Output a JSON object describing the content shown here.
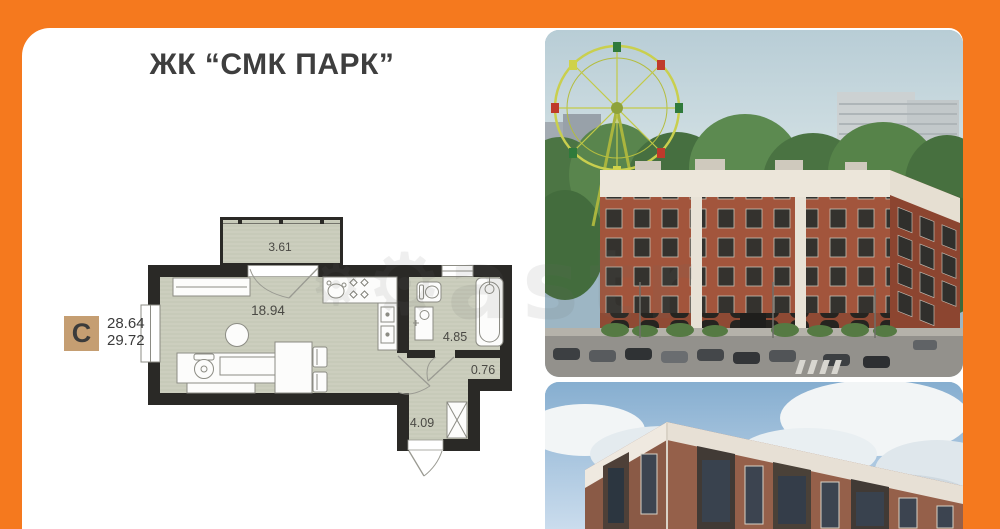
{
  "header": {
    "title": "ЖК “СМК ПАРК”"
  },
  "plan": {
    "badge": "С",
    "area_line1": "28.64",
    "area_line2": "29.72",
    "rooms": {
      "balcony": "3.61",
      "living": "18.94",
      "bathroom": "4.85",
      "storage": "0.76",
      "hall": "4.09"
    }
  },
  "watermark": {
    "text": "astr",
    "icon": "gear-icon"
  },
  "colors": {
    "frame_orange": "#f5791e",
    "badge_tan": "#c59e72",
    "plan_wall": "#2a2926",
    "plan_floor": "#c7cab9",
    "title_text": "#3e3e3e",
    "brick": "#a2553c"
  }
}
